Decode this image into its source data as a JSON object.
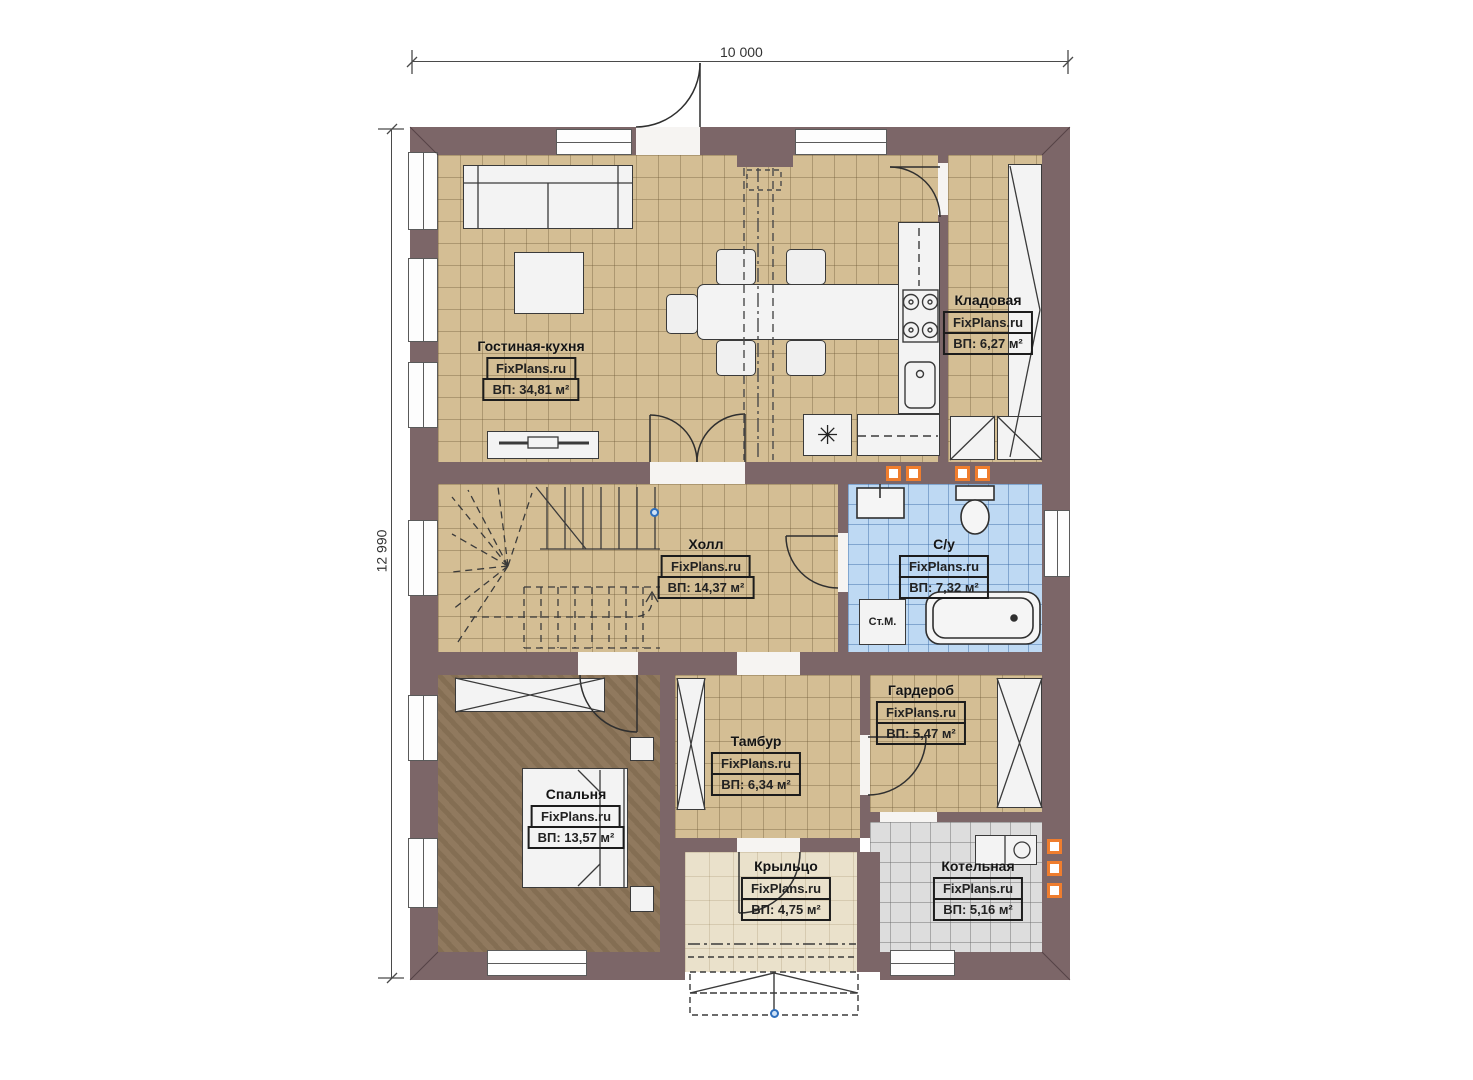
{
  "dimensions": {
    "width": "10 000",
    "height": "12 990"
  },
  "watermark": "FixPlans.ru",
  "rooms": {
    "living": {
      "name": "Гостиная-кухня",
      "area": "ВП: 34,81 м²"
    },
    "storage": {
      "name": "Кладовая",
      "area": "ВП: 6,27 м²"
    },
    "hall": {
      "name": "Холл",
      "area": "ВП: 14,37 м²"
    },
    "bathroom": {
      "name": "С/у",
      "area": "ВП: 7,32 м²"
    },
    "bedroom": {
      "name": "Спальня",
      "area": "ВП: 13,57 м²"
    },
    "vestibule": {
      "name": "Тамбур",
      "area": "ВП: 6,34 м²"
    },
    "wardrobe": {
      "name": "Гардероб",
      "area": "ВП: 5,47 м²"
    },
    "porch": {
      "name": "Крыльцо",
      "area": "ВП: 4,75 м²"
    },
    "boiler": {
      "name": "Котельная",
      "area": "ВП: 5,16 м²"
    }
  },
  "fixtures": {
    "washing_machine": "Ст.М.",
    "fridge_symbol": "✳"
  },
  "colors": {
    "wall": "#7c6668",
    "floor_beige": "#d4be94",
    "floor_blue": "#bed9f3",
    "floor_gray": "#dddddd",
    "floor_bedroom": "#8b7457",
    "floor_porch": "#eae1cb",
    "vent_orange": "#ef7d2e",
    "marker_blue": "#2e6fbd"
  }
}
